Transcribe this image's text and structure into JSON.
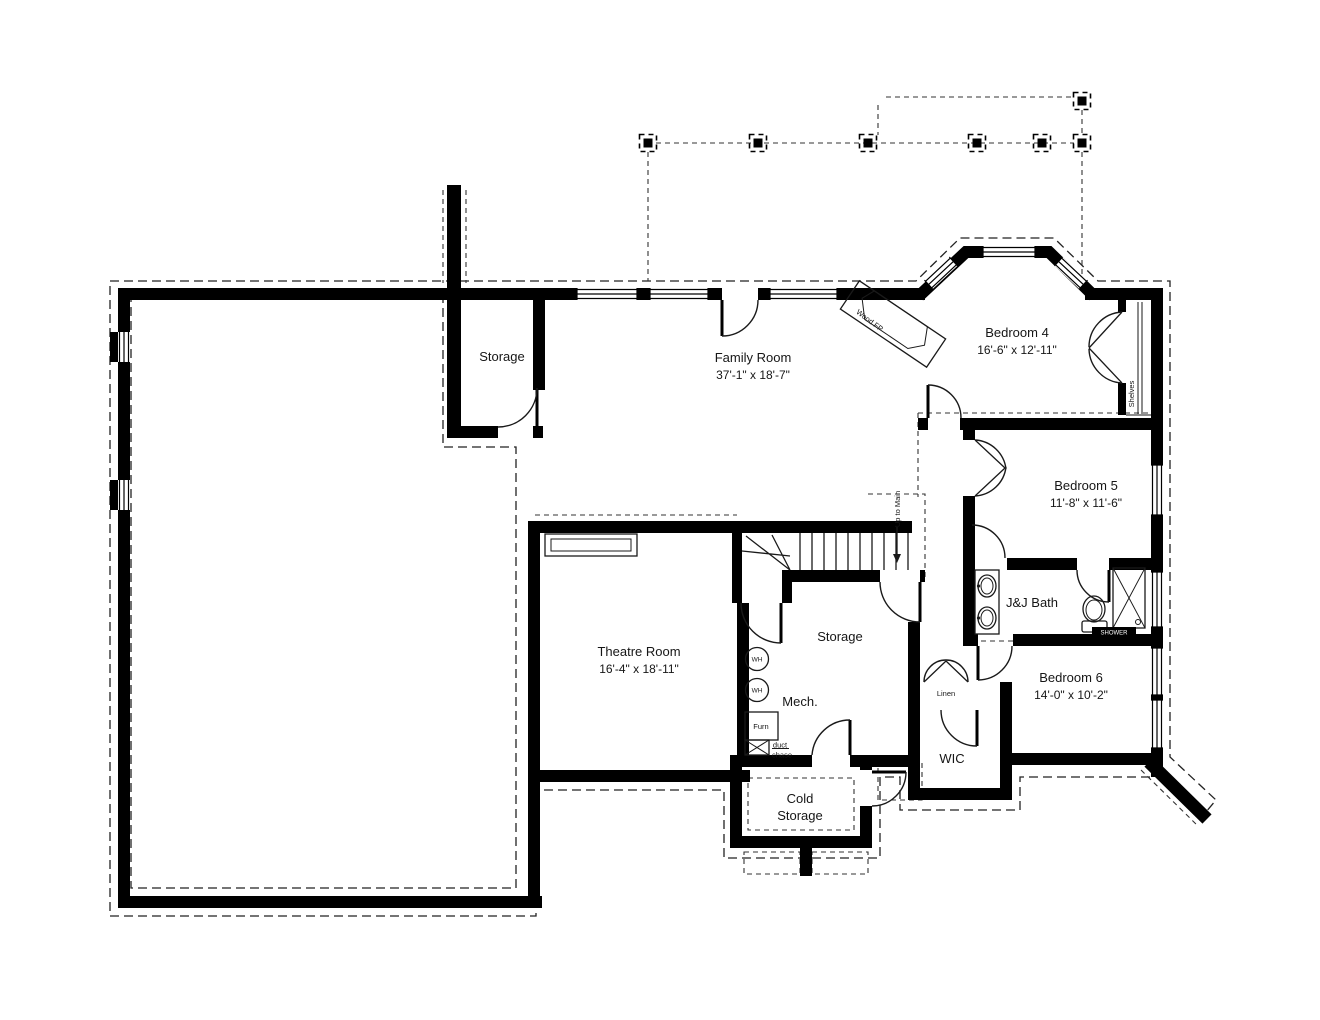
{
  "colors": {
    "wall": "#000000",
    "background": "#ffffff",
    "line": "#1a1a1a"
  },
  "rooms": [
    {
      "id": "storage-upper",
      "label": "Storage"
    },
    {
      "id": "family-room",
      "label": "Family Room",
      "dims": "37'-1\" x 18'-7\""
    },
    {
      "id": "bedroom-4",
      "label": "Bedroom 4",
      "dims": "16'-6\" x 12'-11\""
    },
    {
      "id": "bedroom-5",
      "label": "Bedroom 5",
      "dims": "11'-8\" x 11'-6\""
    },
    {
      "id": "jj-bath",
      "label": "J&J Bath"
    },
    {
      "id": "bedroom-6",
      "label": "Bedroom 6",
      "dims": "14'-0\" x 10'-2\""
    },
    {
      "id": "theatre-room",
      "label": "Theatre Room",
      "dims": "16'-4\" x 18'-11\""
    },
    {
      "id": "storage-middle",
      "label": "Storage"
    },
    {
      "id": "mech",
      "label": "Mech."
    },
    {
      "id": "cold-storage",
      "label_line1": "Cold",
      "label_line2": "Storage"
    },
    {
      "id": "wic",
      "label": "WIC"
    },
    {
      "id": "linen",
      "label": "Linen"
    }
  ],
  "annotations": {
    "wood_fireplace": "Wood FP",
    "shelves": "Shelves",
    "up_to_main": "Up to Main",
    "water_heater": "WH",
    "furnace": "Furn",
    "duct_chase_line1": "duct",
    "duct_chase_line2": "chase",
    "shower": "SHOWER"
  }
}
